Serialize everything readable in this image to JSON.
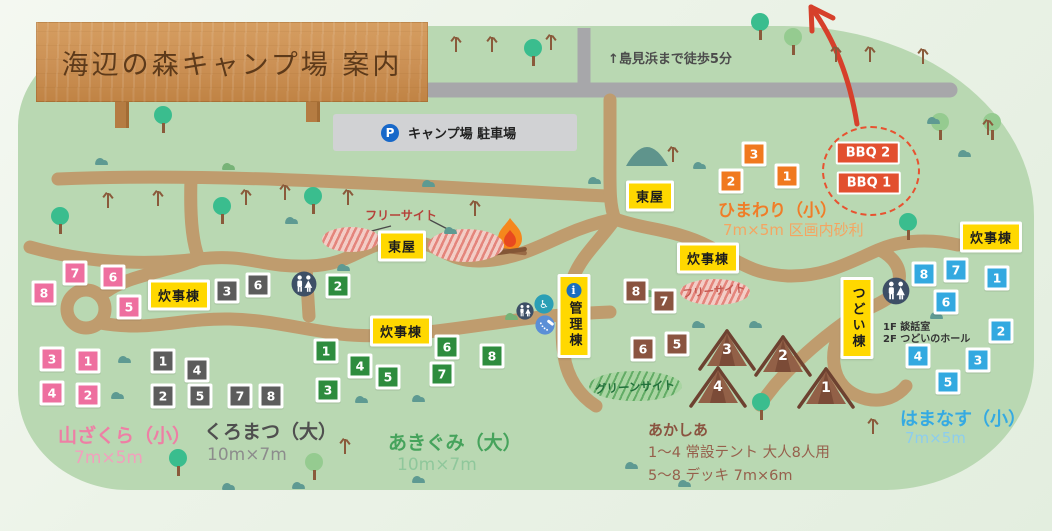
{
  "sign": {
    "title": "海辺の森キャンプ場 案内"
  },
  "beach_note": "↑島見浜まで徒歩5分",
  "parking": {
    "icon": "P",
    "label": "キャンプ場 駐車場"
  },
  "free_site": {
    "label": "フリーサイト",
    "inline_label": "フリーサイト"
  },
  "green_site": {
    "label": "グリーンサイト"
  },
  "bbq": {
    "labels": [
      "BBQ 2",
      "BBQ 1"
    ],
    "color": "#e2502f"
  },
  "tsudoi_info": [
    "1F 談話室",
    "2F つどいのホール"
  ],
  "areas": {
    "yamazakura": {
      "name": "山ざくら（小）",
      "size": "7m×5m"
    },
    "kuromatsu": {
      "name": "くろまつ（大）",
      "size": "10m×7m"
    },
    "akigumi": {
      "name": "あきぐみ（大）",
      "size": "10m×7m"
    },
    "himawari": {
      "name": "ひまわり（小）",
      "size": "7m×5m 区画内砂利"
    },
    "akashia": {
      "name": "あかしあ",
      "note1": "1～4 常設テント 大人8人用",
      "note2": "5～8 デッキ 7m×6m"
    },
    "hamanasu": {
      "name": "はまなす（小）",
      "size": "7m×5m"
    }
  },
  "site_groups": {
    "yamazakura": {
      "color": "#ee6f9f"
    },
    "kuromatsu": {
      "color": "#5c5c5c"
    },
    "akigumi": {
      "color": "#2e8c3e"
    },
    "himawari": {
      "color": "#f0791f"
    },
    "akashia_deck": {
      "color": "#8a5440"
    },
    "hamanasu": {
      "color": "#33a9e0"
    }
  },
  "site_markers": [
    {
      "group": "yamazakura",
      "n": "8",
      "x": 44,
      "y": 293
    },
    {
      "group": "yamazakura",
      "n": "7",
      "x": 75,
      "y": 273
    },
    {
      "group": "yamazakura",
      "n": "6",
      "x": 113,
      "y": 277
    },
    {
      "group": "yamazakura",
      "n": "5",
      "x": 129,
      "y": 307
    },
    {
      "group": "yamazakura",
      "n": "3",
      "x": 52,
      "y": 359
    },
    {
      "group": "yamazakura",
      "n": "1",
      "x": 88,
      "y": 361
    },
    {
      "group": "yamazakura",
      "n": "4",
      "x": 52,
      "y": 393
    },
    {
      "group": "yamazakura",
      "n": "2",
      "x": 88,
      "y": 395
    },
    {
      "group": "kuromatsu",
      "n": "3",
      "x": 227,
      "y": 291
    },
    {
      "group": "kuromatsu",
      "n": "6",
      "x": 258,
      "y": 285
    },
    {
      "group": "kuromatsu",
      "n": "1",
      "x": 163,
      "y": 361
    },
    {
      "group": "kuromatsu",
      "n": "4",
      "x": 197,
      "y": 370
    },
    {
      "group": "kuromatsu",
      "n": "2",
      "x": 163,
      "y": 396
    },
    {
      "group": "kuromatsu",
      "n": "5",
      "x": 200,
      "y": 396
    },
    {
      "group": "kuromatsu",
      "n": "7",
      "x": 240,
      "y": 396
    },
    {
      "group": "kuromatsu",
      "n": "8",
      "x": 271,
      "y": 396
    },
    {
      "group": "akigumi",
      "n": "2",
      "x": 338,
      "y": 286
    },
    {
      "group": "akigumi",
      "n": "1",
      "x": 326,
      "y": 351
    },
    {
      "group": "akigumi",
      "n": "4",
      "x": 360,
      "y": 366
    },
    {
      "group": "akigumi",
      "n": "5",
      "x": 388,
      "y": 377
    },
    {
      "group": "akigumi",
      "n": "6",
      "x": 447,
      "y": 347
    },
    {
      "group": "akigumi",
      "n": "7",
      "x": 442,
      "y": 374
    },
    {
      "group": "akigumi",
      "n": "8",
      "x": 492,
      "y": 356
    },
    {
      "group": "akigumi",
      "n": "3",
      "x": 328,
      "y": 390
    },
    {
      "group": "himawari",
      "n": "3",
      "x": 754,
      "y": 154
    },
    {
      "group": "himawari",
      "n": "2",
      "x": 731,
      "y": 181
    },
    {
      "group": "himawari",
      "n": "1",
      "x": 787,
      "y": 176
    },
    {
      "group": "akashia_deck",
      "n": "8",
      "x": 636,
      "y": 291
    },
    {
      "group": "akashia_deck",
      "n": "7",
      "x": 664,
      "y": 301
    },
    {
      "group": "akashia_deck",
      "n": "6",
      "x": 643,
      "y": 349
    },
    {
      "group": "akashia_deck",
      "n": "5",
      "x": 677,
      "y": 344
    },
    {
      "group": "hamanasu",
      "n": "8",
      "x": 924,
      "y": 274
    },
    {
      "group": "hamanasu",
      "n": "7",
      "x": 956,
      "y": 270
    },
    {
      "group": "hamanasu",
      "n": "1",
      "x": 997,
      "y": 278
    },
    {
      "group": "hamanasu",
      "n": "6",
      "x": 946,
      "y": 302
    },
    {
      "group": "hamanasu",
      "n": "2",
      "x": 1001,
      "y": 331
    },
    {
      "group": "hamanasu",
      "n": "4",
      "x": 918,
      "y": 356
    },
    {
      "group": "hamanasu",
      "n": "3",
      "x": 978,
      "y": 360
    },
    {
      "group": "hamanasu",
      "n": "5",
      "x": 948,
      "y": 382
    }
  ],
  "tents": [
    {
      "n": "3",
      "x": 727,
      "y": 349
    },
    {
      "n": "2",
      "x": 783,
      "y": 355
    },
    {
      "n": "4",
      "x": 718,
      "y": 386
    },
    {
      "n": "1",
      "x": 826,
      "y": 387
    }
  ],
  "facility_labels": [
    {
      "text": "東屋",
      "x": 402,
      "y": 246
    },
    {
      "text": "東屋",
      "x": 650,
      "y": 196
    },
    {
      "text": "炊事棟",
      "x": 179,
      "y": 295
    },
    {
      "text": "炊事棟",
      "x": 401,
      "y": 331
    },
    {
      "text": "炊事棟",
      "x": 708,
      "y": 258
    },
    {
      "text": "炊事棟",
      "x": 991,
      "y": 237
    },
    {
      "text": "管理棟",
      "x": 574,
      "y": 316,
      "vertical": true,
      "info": true
    },
    {
      "text": "つどい棟",
      "x": 857,
      "y": 318,
      "vertical": true
    }
  ],
  "facility_icons": [
    {
      "type": "restroom",
      "x": 304,
      "y": 286,
      "r": 13
    },
    {
      "type": "restroom",
      "x": 896,
      "y": 293,
      "r": 14
    },
    {
      "type": "restroom",
      "x": 525,
      "y": 313,
      "r": 9
    },
    {
      "type": "wheelchair",
      "x": 544,
      "y": 306,
      "r": 10
    },
    {
      "type": "shower",
      "x": 545,
      "y": 327,
      "r": 10
    }
  ],
  "colors": {
    "map_green": "#b9d8b2",
    "path_tan": "#bf9c6e",
    "road_gray": "#a7a7aa",
    "label_yellow": "#ffd800",
    "arrow_red": "#d6402b",
    "yamazakura_text": "#ee7fa5",
    "kuromatsu_text": "#4f4f4f",
    "akigumi_text": "#46a35c",
    "himawari_text": "#f07d28",
    "akashia_text": "#8a5440",
    "hamanasu_text": "#35aae2"
  }
}
